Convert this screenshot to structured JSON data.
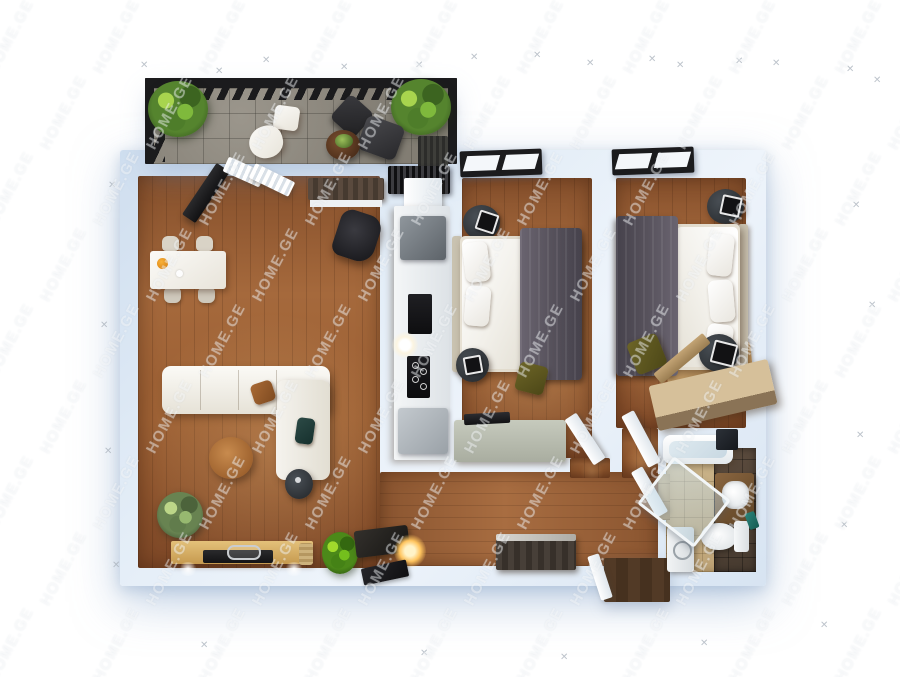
{
  "meta": {
    "width": 900,
    "height": 677,
    "kind": "3d-floor-plan-render"
  },
  "watermark": {
    "text": "HOME.GE",
    "color": "rgba(255,255,255,0.42)",
    "angle_deg": -62
  },
  "sparkle": {
    "glyph": "✕"
  },
  "palette": {
    "background": "#ffffff",
    "wall": "#d7e4f2",
    "wall_shadow": "#9fbbd9",
    "wood_floor": "#9c5f33",
    "balcony_tile": "#8a857b",
    "frame_black": "#1b1b1d",
    "sofa_white": "#f1efe9",
    "bed_blanket_gray": "#5b5560",
    "bed_sheet_white": "#f7f6f3",
    "nightstand_dark": "#33383d",
    "accent_tan": "#b8793f",
    "plant_green": "#5d9636",
    "chest_sage": "#b9beb0",
    "bath_tile_beige": "#c3ad83",
    "bath_tile_dark": "#504235",
    "counter_white": "#eef0f2",
    "appliance_black": "#141417",
    "olive": "#5c5a1f",
    "console_wood": "#d8b46a",
    "entry_mat_brown": "#4a3424"
  },
  "rooms": [
    {
      "name": "balcony"
    },
    {
      "name": "living-room"
    },
    {
      "name": "kitchen"
    },
    {
      "name": "bedroom-1"
    },
    {
      "name": "bedroom-2"
    },
    {
      "name": "hallway"
    },
    {
      "name": "bathroom"
    }
  ]
}
